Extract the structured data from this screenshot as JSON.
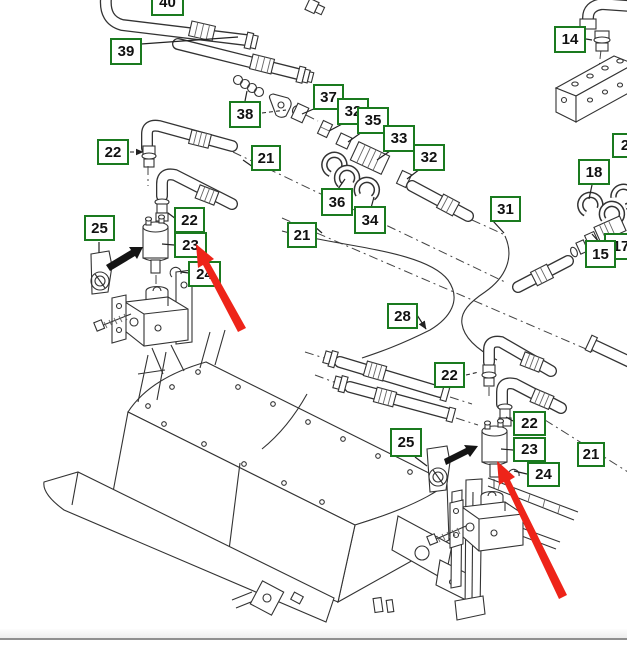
{
  "diagram": {
    "kind": "exploded-parts-diagram",
    "background": "#ffffff",
    "callout_border_color": "#1a7a1f",
    "callout_text_color": "#111111",
    "line_color": "#333333",
    "red_arrow_color": "#ee2419",
    "black_arrow_color": "#141414",
    "callouts": [
      {
        "label": "40",
        "x": 151,
        "y": -11,
        "w": 33,
        "h": 27
      },
      {
        "label": "39",
        "x": 110,
        "y": 38,
        "w": 32,
        "h": 27
      },
      {
        "label": "38",
        "x": 229,
        "y": 101,
        "w": 32,
        "h": 27
      },
      {
        "label": "14",
        "x": 554,
        "y": 26,
        "w": 32,
        "h": 27
      },
      {
        "label": "22",
        "x": 97,
        "y": 139,
        "w": 32,
        "h": 26
      },
      {
        "label": "21",
        "x": 251,
        "y": 145,
        "w": 30,
        "h": 26
      },
      {
        "label": "21",
        "x": 287,
        "y": 222,
        "w": 30,
        "h": 26
      },
      {
        "label": "37",
        "x": 313,
        "y": 84,
        "w": 31,
        "h": 26
      },
      {
        "label": "32",
        "x": 337,
        "y": 98,
        "w": 32,
        "h": 27
      },
      {
        "label": "35",
        "x": 357,
        "y": 107,
        "w": 32,
        "h": 27
      },
      {
        "label": "33",
        "x": 383,
        "y": 125,
        "w": 32,
        "h": 27
      },
      {
        "label": "32",
        "x": 413,
        "y": 144,
        "w": 32,
        "h": 27
      },
      {
        "label": "36",
        "x": 321,
        "y": 188,
        "w": 32,
        "h": 28
      },
      {
        "label": "34",
        "x": 354,
        "y": 206,
        "w": 32,
        "h": 28
      },
      {
        "label": "31",
        "x": 490,
        "y": 196,
        "w": 31,
        "h": 26
      },
      {
        "label": "18",
        "x": 578,
        "y": 159,
        "w": 32,
        "h": 26
      },
      {
        "label": "2",
        "x": 612,
        "y": 133,
        "w": 26,
        "h": 25
      },
      {
        "label": "17",
        "x": 604,
        "y": 233,
        "w": 34,
        "h": 27
      },
      {
        "label": "15",
        "x": 585,
        "y": 240,
        "w": 31,
        "h": 28
      },
      {
        "label": "28",
        "x": 387,
        "y": 303,
        "w": 31,
        "h": 26
      },
      {
        "label": "22",
        "x": 174,
        "y": 207,
        "w": 31,
        "h": 26
      },
      {
        "label": "23",
        "x": 174,
        "y": 232,
        "w": 33,
        "h": 26
      },
      {
        "label": "24",
        "x": 188,
        "y": 261,
        "w": 33,
        "h": 26
      },
      {
        "label": "25",
        "x": 84,
        "y": 215,
        "w": 31,
        "h": 26
      },
      {
        "label": "22",
        "x": 434,
        "y": 362,
        "w": 31,
        "h": 26
      },
      {
        "label": "25",
        "x": 390,
        "y": 428,
        "w": 32,
        "h": 29
      },
      {
        "label": "22",
        "x": 513,
        "y": 411,
        "w": 33,
        "h": 25
      },
      {
        "label": "23",
        "x": 513,
        "y": 437,
        "w": 33,
        "h": 25
      },
      {
        "label": "24",
        "x": 527,
        "y": 462,
        "w": 33,
        "h": 25
      },
      {
        "label": "21",
        "x": 577,
        "y": 442,
        "w": 28,
        "h": 25
      }
    ]
  }
}
